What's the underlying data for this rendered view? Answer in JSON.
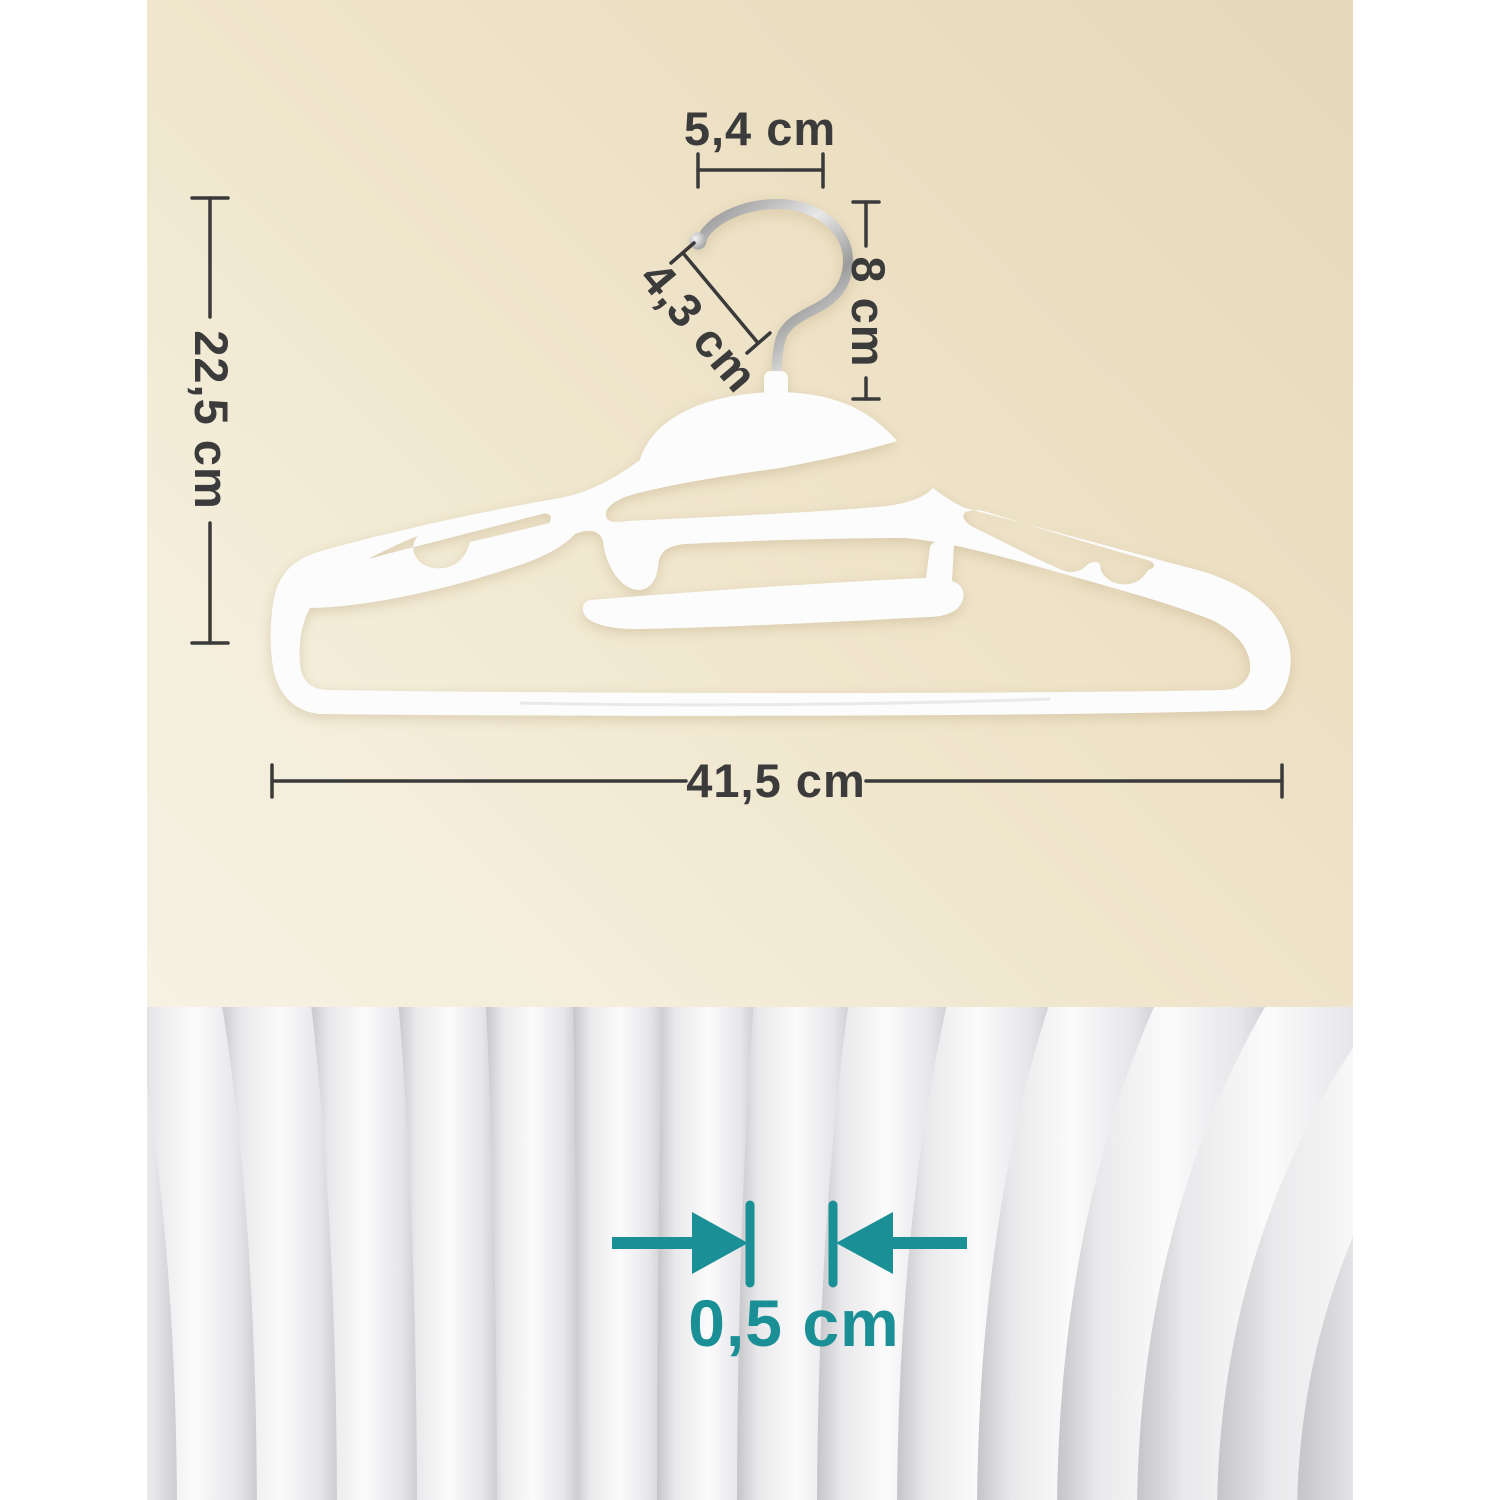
{
  "diagram": {
    "labels": {
      "hook_width": "5,4 cm",
      "hook_height": "8 cm",
      "hook_opening": "4,3 cm",
      "total_height": "22,5 cm",
      "total_width": "41,5 cm",
      "thickness": "0,5 cm"
    }
  },
  "colors": {
    "accent_teal": "#1a8f96",
    "dim_color": "#3b3b3b",
    "beige_top": "#e6d8ba",
    "beige_bottom": "#f6f1e2",
    "hanger_white": "#fcfcfd"
  }
}
